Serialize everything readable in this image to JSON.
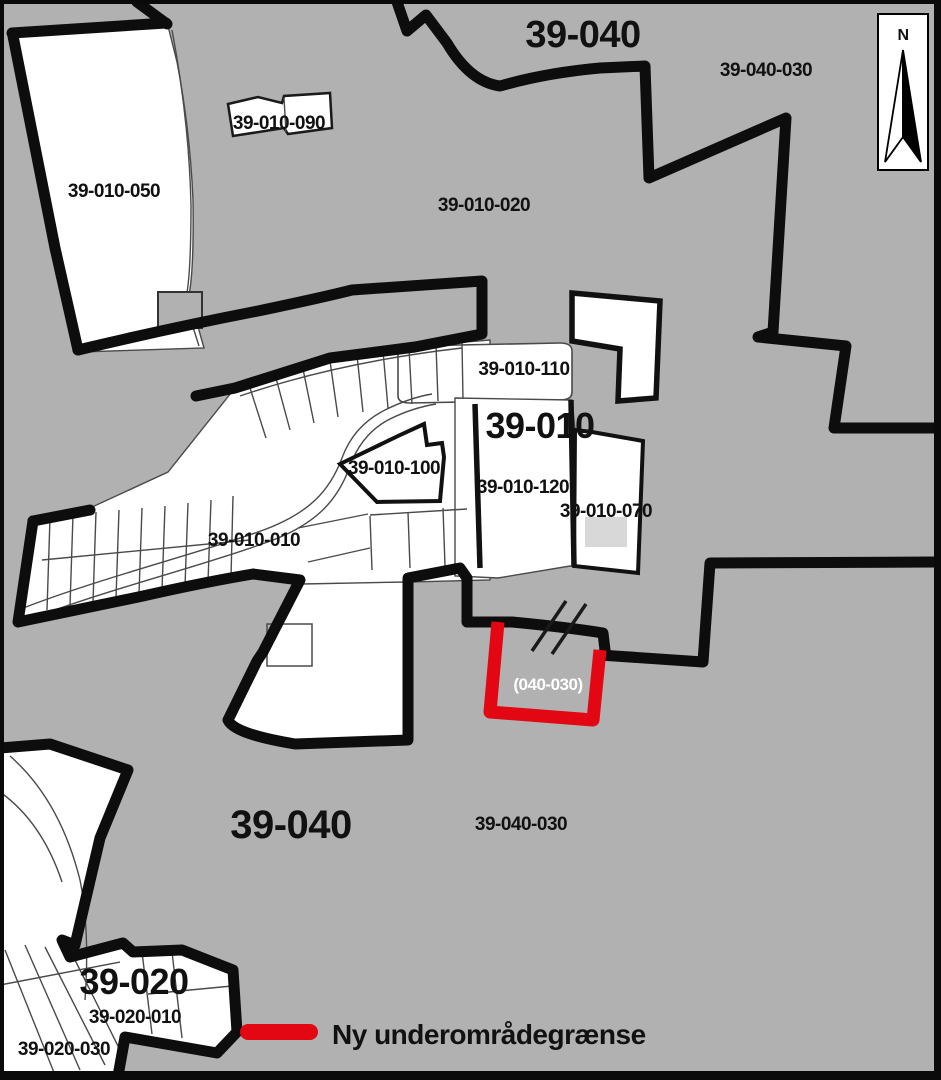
{
  "map": {
    "title_hint": "Plan subarea boundary map",
    "background_color": "#b1b1b1",
    "boundary_color": "#0d0d0d",
    "parcel_fill": "#ffffff",
    "building_fill": "#d8d8d8",
    "new_boundary_color": "#e30613",
    "labels": [
      {
        "id": "district-39-040-top",
        "text": "39-040",
        "x": 583,
        "y": 47,
        "size": 38
      },
      {
        "id": "area-39-040-030-top",
        "text": "39-040-030",
        "x": 766,
        "y": 76,
        "size": 19
      },
      {
        "id": "area-39-010-090",
        "text": "39-010-090",
        "x": 279,
        "y": 129,
        "size": 19
      },
      {
        "id": "area-39-010-050",
        "text": "39-010-050",
        "x": 114,
        "y": 197,
        "size": 19
      },
      {
        "id": "area-39-010-020",
        "text": "39-010-020",
        "x": 484,
        "y": 211,
        "size": 19
      },
      {
        "id": "area-39-010-110",
        "text": "39-010-110",
        "x": 524,
        "y": 375,
        "size": 19
      },
      {
        "id": "district-39-010",
        "text": "39-010",
        "x": 540,
        "y": 438,
        "size": 36
      },
      {
        "id": "area-39-010-100",
        "text": "39-010-100",
        "x": 394,
        "y": 474,
        "size": 19
      },
      {
        "id": "area-39-010-120",
        "text": "39-010-120",
        "x": 523,
        "y": 493,
        "size": 19
      },
      {
        "id": "area-39-010-070",
        "text": "39-010-070",
        "x": 606,
        "y": 517,
        "size": 19
      },
      {
        "id": "area-39-010-010",
        "text": "39-010-010",
        "x": 254,
        "y": 546,
        "size": 19
      },
      {
        "id": "new-area-040-030",
        "text": "(040-030)",
        "x": 548,
        "y": 690,
        "size": 17,
        "color": "#ffffff"
      },
      {
        "id": "district-39-040-bottom",
        "text": "39-040",
        "x": 291,
        "y": 838,
        "size": 40
      },
      {
        "id": "area-39-040-030-bottom",
        "text": "39-040-030",
        "x": 521,
        "y": 830,
        "size": 19
      },
      {
        "id": "district-39-020",
        "text": "39-020",
        "x": 134,
        "y": 994,
        "size": 36
      },
      {
        "id": "area-39-020-010",
        "text": "39-020-010",
        "x": 135,
        "y": 1023,
        "size": 19
      },
      {
        "id": "area-39-020-030",
        "text": "39-020-030",
        "x": 64,
        "y": 1055,
        "size": 19
      },
      {
        "id": "north-letter",
        "text": "N",
        "x": 903,
        "y": 40,
        "size": 16
      },
      {
        "id": "legend-new-subarea-boundary",
        "text": "Ny underområdegrænse",
        "x": 332,
        "y": 1044,
        "size": 28,
        "anchor": "start"
      }
    ],
    "legend": {
      "line_color": "#e30613"
    },
    "north_arrow": {
      "letter": "N"
    }
  }
}
